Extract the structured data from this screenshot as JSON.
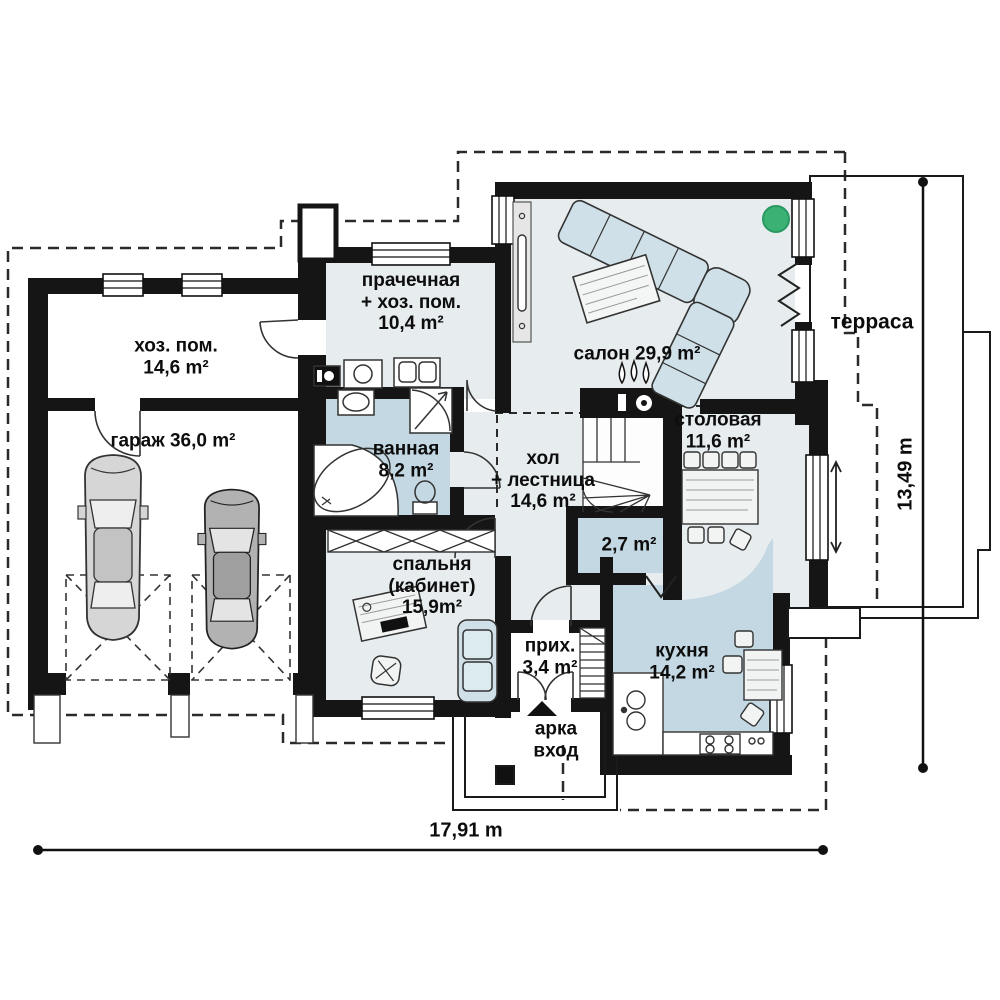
{
  "plan": {
    "rooms": {
      "utility": {
        "lines": [
          "хоз. пом.",
          "14,6 m²"
        ]
      },
      "garage": {
        "lines": [
          "гараж 36,0 m²"
        ]
      },
      "laundry": {
        "lines": [
          "прачечная",
          "+ хоз. пом.",
          "10,4 m²"
        ]
      },
      "salon": {
        "lines": [
          "салон 29,9 m²"
        ]
      },
      "terrace": {
        "lines": [
          "терраса"
        ]
      },
      "bathroom": {
        "lines": [
          "ванная",
          "8,2 m²"
        ]
      },
      "hall": {
        "lines": [
          "хол",
          "+ лестница",
          "14,6 m²"
        ]
      },
      "dining": {
        "lines": [
          "столовая",
          "11,6 m²"
        ]
      },
      "storage": {
        "lines": [
          "2,7 m²"
        ]
      },
      "bedroom": {
        "lines": [
          "спальня",
          "(кабинет)",
          "15,9m²"
        ]
      },
      "hallway": {
        "lines": [
          "прих.",
          "3,4 m²"
        ]
      },
      "kitchen": {
        "lines": [
          "кухня",
          "14,2 m²"
        ]
      },
      "entrance": {
        "lines": [
          "арка",
          "вход"
        ]
      }
    },
    "dimensions": {
      "width": "17,91 m",
      "height": "13,49 m"
    },
    "colors": {
      "wall": "#151515",
      "floor_main": "#e7edef",
      "floor_wet": "#c3d8e2",
      "plant": "#3bb273"
    }
  }
}
